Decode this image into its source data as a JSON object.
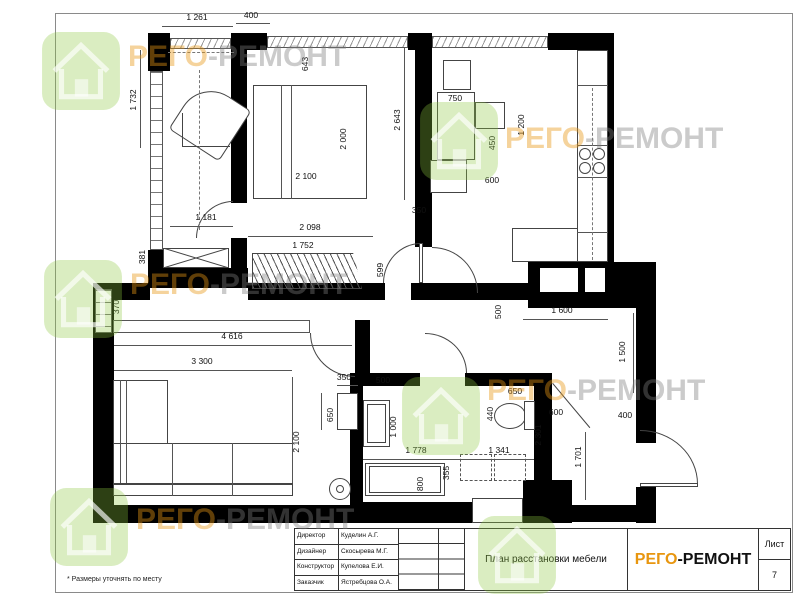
{
  "sheet": {
    "note": "* Размеры уточнять по месту"
  },
  "title_block": {
    "staff": [
      {
        "role": "Директор",
        "name": "Куделин А.Г."
      },
      {
        "role": "Дизайнер",
        "name": "Скосырева М.Г."
      },
      {
        "role": "Конструктор",
        "name": "Купелова Е.И."
      },
      {
        "role": "Заказчик",
        "name": "Ястребцова О.А."
      }
    ],
    "drawing_title": "План расстановки мебели",
    "brand_part1": "РЕГО",
    "brand_part2": "-РЕМОНТ",
    "sheet_label": "Лист",
    "sheet_number": "7"
  },
  "colors": {
    "brand_orange": "#E8960F",
    "wall_black": "#000000",
    "watermark_green": "#8DC63F"
  },
  "watermark": {
    "brand_part1": "РЕГО",
    "brand_part2": "-РЕМОНТ",
    "logo_name": "rego-remont-house-logo",
    "instances": [
      {
        "lx": 40,
        "ly": 30,
        "tx": 128,
        "ty": 40,
        "text": true
      },
      {
        "lx": 418,
        "ly": 100,
        "tx": 505,
        "ty": 122,
        "text": true
      },
      {
        "lx": 42,
        "ly": 258,
        "tx": 130,
        "ty": 268,
        "text": true
      },
      {
        "lx": 400,
        "ly": 375,
        "tx": 487,
        "ty": 374,
        "text": true
      },
      {
        "lx": 48,
        "ly": 486,
        "tx": 136,
        "ty": 503,
        "text": true
      },
      {
        "lx": 476,
        "ly": 514,
        "tx": 0,
        "ty": 0,
        "text": false
      }
    ]
  },
  "dimensions": [
    {
      "text": "1 261",
      "x": 197,
      "y": 17
    },
    {
      "text": "400",
      "x": 251,
      "y": 15
    },
    {
      "text": "1 732",
      "x": 133,
      "y": 100,
      "v": 1
    },
    {
      "text": "643",
      "x": 305,
      "y": 64,
      "v": 1
    },
    {
      "text": "2 643",
      "x": 397,
      "y": 120,
      "v": 1
    },
    {
      "text": "2 000",
      "x": 343,
      "y": 139,
      "v": 1
    },
    {
      "text": "2 100",
      "x": 306,
      "y": 176
    },
    {
      "text": "750",
      "x": 455,
      "y": 98
    },
    {
      "text": "450",
      "x": 492,
      "y": 143,
      "v": 1
    },
    {
      "text": "1 200",
      "x": 521,
      "y": 125,
      "v": 1
    },
    {
      "text": "600",
      "x": 492,
      "y": 180
    },
    {
      "text": "350",
      "x": 419,
      "y": 210
    },
    {
      "text": "2 098",
      "x": 310,
      "y": 227
    },
    {
      "text": "1 752",
      "x": 303,
      "y": 245
    },
    {
      "text": "1 181",
      "x": 206,
      "y": 217
    },
    {
      "text": "381",
      "x": 142,
      "y": 257,
      "v": 1
    },
    {
      "text": "599",
      "x": 380,
      "y": 270,
      "v": 1
    },
    {
      "text": "370",
      "x": 116,
      "y": 307,
      "v": 1
    },
    {
      "text": "4 616",
      "x": 232,
      "y": 336
    },
    {
      "text": "3 300",
      "x": 202,
      "y": 361
    },
    {
      "text": "500",
      "x": 498,
      "y": 312,
      "v": 1
    },
    {
      "text": "1 600",
      "x": 562,
      "y": 310
    },
    {
      "text": "1 500",
      "x": 622,
      "y": 352,
      "v": 1
    },
    {
      "text": "350",
      "x": 344,
      "y": 377
    },
    {
      "text": "500",
      "x": 383,
      "y": 380
    },
    {
      "text": "650",
      "x": 330,
      "y": 415,
      "v": 1
    },
    {
      "text": "2 100",
      "x": 296,
      "y": 442,
      "v": 1
    },
    {
      "text": "650",
      "x": 515,
      "y": 391
    },
    {
      "text": "440",
      "x": 490,
      "y": 414,
      "v": 1
    },
    {
      "text": "600",
      "x": 556,
      "y": 412
    },
    {
      "text": "2 301",
      "x": 538,
      "y": 435,
      "v": 1
    },
    {
      "text": "1 000",
      "x": 393,
      "y": 427,
      "v": 1
    },
    {
      "text": "1 778",
      "x": 416,
      "y": 450
    },
    {
      "text": "1 341",
      "x": 499,
      "y": 450
    },
    {
      "text": "400",
      "x": 625,
      "y": 415
    },
    {
      "text": "1 701",
      "x": 578,
      "y": 457,
      "v": 1
    },
    {
      "text": "800",
      "x": 420,
      "y": 484,
      "v": 1
    },
    {
      "text": "355",
      "x": 446,
      "y": 473,
      "v": 1
    }
  ]
}
